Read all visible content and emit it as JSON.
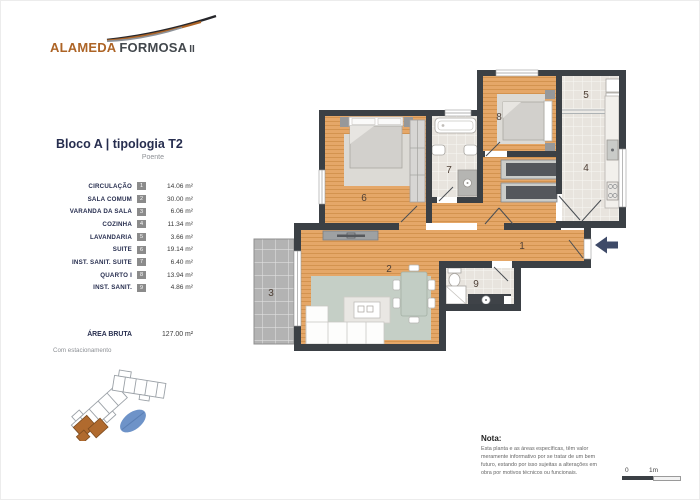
{
  "brand": {
    "primary": "ALAMEDA",
    "secondary": "FORMOSA",
    "suffix": "II"
  },
  "header": {
    "title": "Bloco A  |  tipologia T2",
    "orientation": "Poente"
  },
  "legend": {
    "rooms": [
      {
        "num": "1",
        "name": "CIRCULAÇÃO",
        "area": "14.06 m²"
      },
      {
        "num": "2",
        "name": "SALA COMUM",
        "area": "30.00 m²"
      },
      {
        "num": "3",
        "name": "VARANDA DA SALA",
        "area": "6.06 m²"
      },
      {
        "num": "4",
        "name": "COZINHA",
        "area": "11.34 m²"
      },
      {
        "num": "5",
        "name": "LAVANDARIA",
        "area": "3.66 m²"
      },
      {
        "num": "6",
        "name": "SUITE",
        "area": "19.14 m²"
      },
      {
        "num": "7",
        "name": "INST. SANIT. SUITE",
        "area": "6.40 m²"
      },
      {
        "num": "8",
        "name": "QUARTO I",
        "area": "13.94 m²"
      },
      {
        "num": "9",
        "name": "INST. SANIT.",
        "area": "4.86 m²"
      }
    ],
    "total": {
      "label": "ÁREA BRUTA",
      "area": "127.00 m²",
      "note": "Com estacionamento"
    }
  },
  "note": {
    "title": "Nota:",
    "lines": [
      "Esta planta e as áreas específicas, têm valor",
      "meramente informativo por se tratar de um bem",
      "futuro, estando por isso sujeitas a alterações em",
      "obra por motivos técnicos ou funcionais."
    ]
  },
  "scale": {
    "zero": "0",
    "one": "1m"
  },
  "colors": {
    "accent": "#ad6426",
    "navy": "#272e4f",
    "wall": "#3b4045",
    "wood": "#e5a768",
    "arrow": "#3e4a68"
  }
}
